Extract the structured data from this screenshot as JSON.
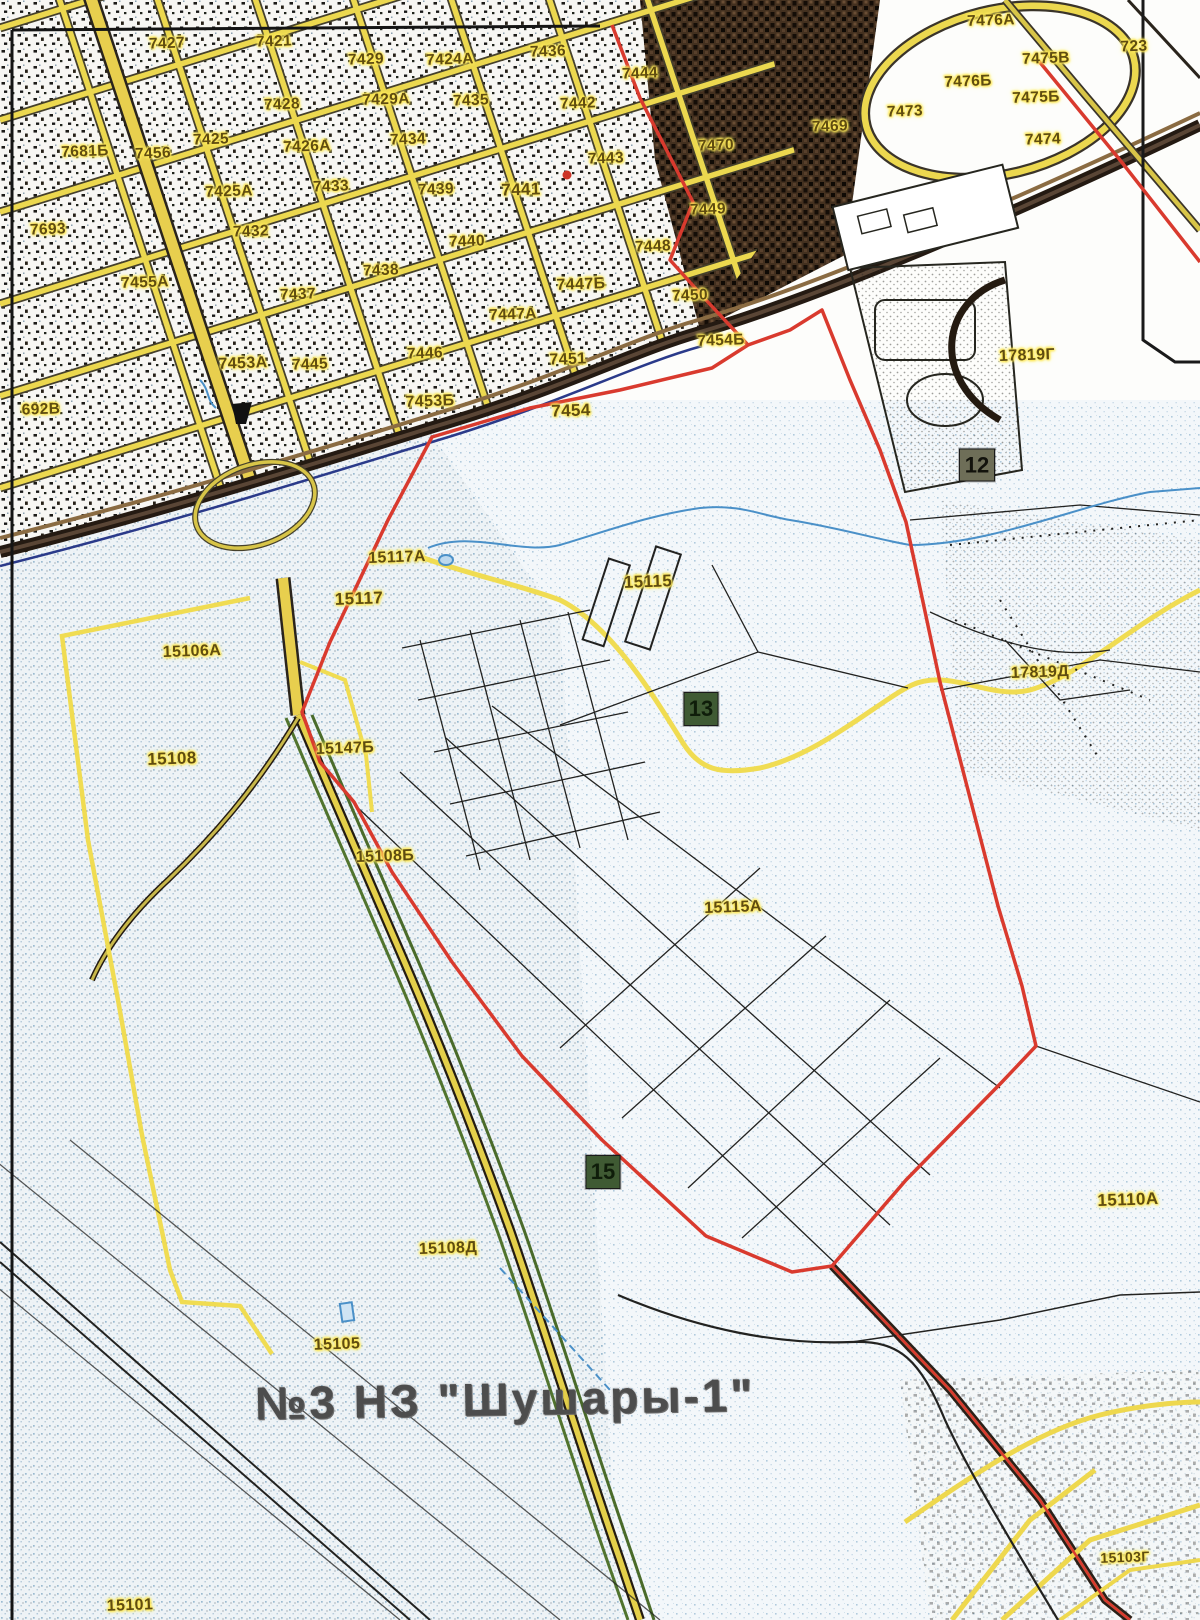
{
  "map": {
    "title": "№3  НЗ \"Шушары-1\"",
    "colors": {
      "parcel_label": "#5f4c10",
      "label_halo": "#ffe959",
      "boundary_red": "#d93a2e",
      "road_yellow": "#ecd84f",
      "railway_dark": "#241a12",
      "field_speckle": "#a8c4da",
      "title_gray": "#4d4d4d",
      "marker_green": "#3f5a33",
      "marker_dark": "#6e6e58"
    },
    "labels": [
      {
        "t": "7427",
        "x": 167,
        "y": 44
      },
      {
        "t": "7421",
        "x": 274,
        "y": 42
      },
      {
        "t": "7429",
        "x": 366,
        "y": 60
      },
      {
        "t": "7424А",
        "x": 450,
        "y": 60
      },
      {
        "t": "7436",
        "x": 548,
        "y": 52
      },
      {
        "t": "7444",
        "x": 640,
        "y": 74
      },
      {
        "t": "7429А",
        "x": 386,
        "y": 100
      },
      {
        "t": "7435",
        "x": 471,
        "y": 101
      },
      {
        "t": "7442",
        "x": 578,
        "y": 104
      },
      {
        "t": "7428",
        "x": 282,
        "y": 105
      },
      {
        "t": "7425",
        "x": 211,
        "y": 140
      },
      {
        "t": "7426А",
        "x": 307,
        "y": 147
      },
      {
        "t": "7434",
        "x": 408,
        "y": 140
      },
      {
        "t": "7443",
        "x": 606,
        "y": 159
      },
      {
        "t": "7470",
        "x": 716,
        "y": 146
      },
      {
        "t": "7469",
        "x": 830,
        "y": 127
      },
      {
        "t": "7473",
        "x": 905,
        "y": 112
      },
      {
        "t": "7476А",
        "x": 991,
        "y": 21
      },
      {
        "t": "7475В",
        "x": 1046,
        "y": 59
      },
      {
        "t": "7476Б",
        "x": 968,
        "y": 82
      },
      {
        "t": "7475Б",
        "x": 1036,
        "y": 98
      },
      {
        "t": "723",
        "x": 1134,
        "y": 47
      },
      {
        "t": "7474",
        "x": 1043,
        "y": 140
      },
      {
        "t": "7681Б",
        "x": 85,
        "y": 152
      },
      {
        "t": "7456",
        "x": 153,
        "y": 154
      },
      {
        "t": "7425А",
        "x": 229,
        "y": 192
      },
      {
        "t": "7433",
        "x": 331,
        "y": 187
      },
      {
        "t": "7439",
        "x": 436,
        "y": 190
      },
      {
        "t": "7441",
        "x": 521,
        "y": 190,
        "s": 17
      },
      {
        "t": "7449",
        "x": 708,
        "y": 210
      },
      {
        "t": "7693",
        "x": 48,
        "y": 230
      },
      {
        "t": "7432",
        "x": 251,
        "y": 232
      },
      {
        "t": "7440",
        "x": 467,
        "y": 242
      },
      {
        "t": "7448",
        "x": 653,
        "y": 247
      },
      {
        "t": "7438",
        "x": 381,
        "y": 271
      },
      {
        "t": "7437",
        "x": 298,
        "y": 295
      },
      {
        "t": "7455А",
        "x": 145,
        "y": 283
      },
      {
        "t": "7447Б",
        "x": 581,
        "y": 285,
        "s": 16
      },
      {
        "t": "7450",
        "x": 690,
        "y": 296
      },
      {
        "t": "7447А",
        "x": 513,
        "y": 315
      },
      {
        "t": "7453А",
        "x": 243,
        "y": 364,
        "s": 16
      },
      {
        "t": "7445",
        "x": 310,
        "y": 365
      },
      {
        "t": "7446",
        "x": 425,
        "y": 354
      },
      {
        "t": "7451",
        "x": 568,
        "y": 360,
        "s": 16
      },
      {
        "t": "7454Б",
        "x": 721,
        "y": 341
      },
      {
        "t": "7453Б",
        "x": 430,
        "y": 402,
        "s": 16
      },
      {
        "t": "7454",
        "x": 571,
        "y": 411,
        "s": 17
      },
      {
        "t": "692В",
        "x": 41,
        "y": 410
      },
      {
        "t": "17819Г",
        "x": 1027,
        "y": 356,
        "s": 16
      },
      {
        "t": "15117А",
        "x": 397,
        "y": 558,
        "s": 16
      },
      {
        "t": "15117",
        "x": 359,
        "y": 599,
        "s": 17
      },
      {
        "t": "15115",
        "x": 648,
        "y": 582,
        "s": 17
      },
      {
        "t": "15106А",
        "x": 192,
        "y": 652,
        "s": 16
      },
      {
        "t": "17819Д",
        "x": 1040,
        "y": 673,
        "s": 16
      },
      {
        "t": "15147Б",
        "x": 345,
        "y": 749,
        "s": 16
      },
      {
        "t": "15108",
        "x": 172,
        "y": 759,
        "s": 17
      },
      {
        "t": "15108Б",
        "x": 385,
        "y": 857,
        "s": 16
      },
      {
        "t": "15115А",
        "x": 733,
        "y": 908,
        "s": 16
      },
      {
        "t": "15110А",
        "x": 1128,
        "y": 1200,
        "s": 17
      },
      {
        "t": "15108Д",
        "x": 448,
        "y": 1249,
        "s": 16
      },
      {
        "t": "15105",
        "x": 337,
        "y": 1345,
        "s": 16
      },
      {
        "t": "15103Г",
        "x": 1125,
        "y": 1557,
        "s": 14
      },
      {
        "t": "15101",
        "x": 130,
        "y": 1606,
        "s": 16
      }
    ],
    "markers": [
      {
        "t": "12",
        "x": 977,
        "y": 465,
        "v": "dark"
      },
      {
        "t": "13",
        "x": 701,
        "y": 709,
        "v": "green"
      },
      {
        "t": "15",
        "x": 603,
        "y": 1172,
        "v": "green"
      }
    ]
  }
}
